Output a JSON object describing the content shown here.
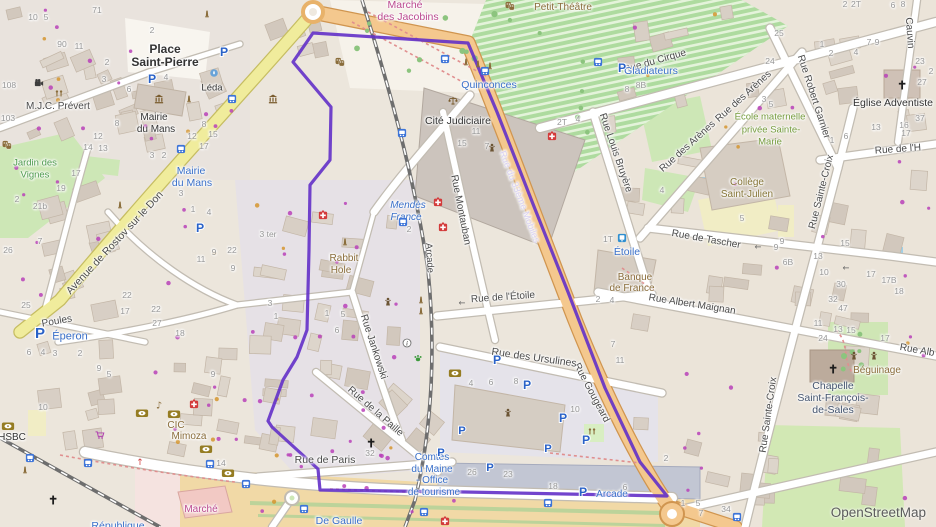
{
  "attribution": {
    "text": "OpenStreetMap"
  },
  "palette": {
    "st": "#4b4b4b",
    "hn": "#979797",
    "tr": "#3a70c9",
    "poi": "#8a6d3b",
    "pl": "#333333",
    "ar": "#4e9a4e",
    "olive": "#769c3e",
    "khaki": "#857537",
    "pink": "#bb4a90",
    "slate": "#44546e",
    "lav": "#d9d1f2",
    "attr": "#5b5b5b",
    "boundary": "#6330c8",
    "parking_blue": "#2a62c8",
    "transit_blue": "#3d74d8",
    "medical_red": "#d33a3a",
    "bank_olive": "#957c22"
  },
  "boundary": {
    "name": "highlighted-district-boundary",
    "points": "313,33 468,43 476,62 497,112 533,204 568,292 605,388 640,462 667,496 465,492 320,490 318,469 272,427 268,421 283,380 297,357 307,330 309,250 310,185 330,160 331,107 293,62"
  },
  "labels": [
    {
      "t": "Place",
      "x": 165,
      "y": 49,
      "k": "pl",
      "s": 12,
      "w": 600
    },
    {
      "t": "Saint-Pierre",
      "x": 165,
      "y": 62,
      "k": "pl",
      "s": 12,
      "w": 600
    },
    {
      "t": "Marché",
      "x": 405,
      "y": 5,
      "k": "poi",
      "c": "pink",
      "s": 10.5
    },
    {
      "t": "des Jacobins",
      "x": 408,
      "y": 17,
      "k": "poi",
      "c": "pink",
      "s": 10.5
    },
    {
      "t": "Petit-Théâtre",
      "x": 563,
      "y": 8,
      "k": "poi"
    },
    {
      "t": "Rue du Cirque",
      "x": 655,
      "y": 62,
      "r": -16
    },
    {
      "t": "Cauvin",
      "x": 909,
      "y": 33,
      "r": 86
    },
    {
      "t": "Rue Robert Garnier",
      "x": 813,
      "y": 97,
      "r": 72
    },
    {
      "t": "Rue de l'H",
      "x": 898,
      "y": 150,
      "r": -4
    },
    {
      "t": "Église Adventiste",
      "x": 893,
      "y": 103,
      "k": "pl",
      "s": 10.5
    },
    {
      "t": "Gladiateurs",
      "x": 651,
      "y": 71,
      "k": "tr",
      "s": 10.5
    },
    {
      "t": "Quinconces",
      "x": 489,
      "y": 85,
      "k": "tr",
      "s": 10.5
    },
    {
      "t": "Rue Louis Bruyère",
      "x": 615,
      "y": 153,
      "r": 71
    },
    {
      "t": "Rue des Arènes",
      "x": 688,
      "y": 147,
      "r": -42
    },
    {
      "t": "Rue des Arènes",
      "x": 744,
      "y": 97,
      "r": -42
    },
    {
      "t": "École maternelle",
      "x": 770,
      "y": 117,
      "k": "ar",
      "c": "olive",
      "s": 9.5
    },
    {
      "t": "privée Sainte-",
      "x": 771,
      "y": 130,
      "k": "ar",
      "c": "olive",
      "s": 9.5
    },
    {
      "t": "Marie",
      "x": 770,
      "y": 142,
      "k": "ar",
      "c": "olive",
      "s": 9.5
    },
    {
      "t": "Collège",
      "x": 747,
      "y": 183,
      "k": "ar",
      "c": "khaki"
    },
    {
      "t": "Saint-Julien",
      "x": 747,
      "y": 195,
      "k": "ar",
      "c": "khaki"
    },
    {
      "t": "Rue de Tascher",
      "x": 706,
      "y": 240,
      "r": 10
    },
    {
      "t": "Étoile",
      "x": 627,
      "y": 252,
      "k": "tr",
      "s": 10.5
    },
    {
      "t": "Banque",
      "x": 635,
      "y": 278,
      "k": "poi"
    },
    {
      "t": "de France",
      "x": 632,
      "y": 289,
      "k": "poi"
    },
    {
      "t": "Rue Albert Maignan",
      "x": 692,
      "y": 305,
      "r": 9
    },
    {
      "t": "Rue Alb",
      "x": 917,
      "y": 351,
      "r": 10
    },
    {
      "t": "Rue Sainte-Croix",
      "x": 822,
      "y": 192,
      "r": -76
    },
    {
      "t": "Rue Sainte-Croix",
      "x": 769,
      "y": 415,
      "r": -82
    },
    {
      "t": "Béguinage",
      "x": 877,
      "y": 371,
      "k": "poi"
    },
    {
      "t": "Chapelle",
      "x": 833,
      "y": 386,
      "k": "pl",
      "c": "slate",
      "s": 10.5
    },
    {
      "t": "Saint-François-",
      "x": 833,
      "y": 398,
      "k": "pl",
      "c": "slate",
      "s": 10.5
    },
    {
      "t": "de-Sales",
      "x": 833,
      "y": 410,
      "k": "pl",
      "c": "slate",
      "s": 10.5
    },
    {
      "t": "Cité Judiciaire",
      "x": 458,
      "y": 121,
      "k": "pl",
      "s": 10.5
    },
    {
      "t": "Rue Montauban",
      "x": 460,
      "y": 210,
      "r": 79
    },
    {
      "t": "Mendès",
      "x": 408,
      "y": 206,
      "k": "tr",
      "i": 1
    },
    {
      "t": "France",
      "x": 406,
      "y": 218,
      "k": "tr",
      "i": 1
    },
    {
      "t": "Arcade",
      "x": 429,
      "y": 258,
      "r": 86,
      "s": 9.5
    },
    {
      "t": "Rabbit",
      "x": 344,
      "y": 259,
      "k": "poi"
    },
    {
      "t": "Hole",
      "x": 341,
      "y": 271,
      "k": "poi"
    },
    {
      "t": "Rue du 33ème Mobiles",
      "x": 519,
      "y": 197,
      "r": 69,
      "c": "lav",
      "s": 9.5
    },
    {
      "t": "Rue Gougeard",
      "x": 591,
      "y": 393,
      "r": 62
    },
    {
      "t": "Rue de l'Étoile",
      "x": 503,
      "y": 298,
      "r": -4
    },
    {
      "t": "Rue des Ursulines",
      "x": 534,
      "y": 358,
      "r": 8,
      "s": 10.5
    },
    {
      "t": "Rue Jankowski",
      "x": 373,
      "y": 347,
      "r": 72
    },
    {
      "t": "Rue de la Paille",
      "x": 375,
      "y": 412,
      "r": 41
    },
    {
      "t": "Rue de Paris",
      "x": 325,
      "y": 460,
      "s": 10.5
    },
    {
      "t": "Avenue de Rostov sur le Don",
      "x": 115,
      "y": 243,
      "r": -47,
      "s": 10.5
    },
    {
      "t": "Poules",
      "x": 57,
      "y": 322,
      "r": -10
    },
    {
      "t": "Jardin des",
      "x": 35,
      "y": 163,
      "k": "ar",
      "s": 9.5
    },
    {
      "t": "Vignes",
      "x": 35,
      "y": 175,
      "k": "ar",
      "s": 9.5
    },
    {
      "t": "M.J.C. Prévert",
      "x": 58,
      "y": 107
    },
    {
      "t": "Mairie",
      "x": 154,
      "y": 118,
      "k": "pl"
    },
    {
      "t": "du Mans",
      "x": 156,
      "y": 130,
      "k": "pl"
    },
    {
      "t": "Léda",
      "x": 212,
      "y": 88,
      "k": "pl",
      "s": 9.5
    },
    {
      "t": "Mairie",
      "x": 191,
      "y": 171,
      "k": "tr",
      "s": 10.5
    },
    {
      "t": "du Mans",
      "x": 192,
      "y": 183,
      "k": "tr",
      "s": 10.5
    },
    {
      "t": "Éperon",
      "x": 70,
      "y": 337,
      "k": "tr",
      "s": 11
    },
    {
      "t": "CIC",
      "x": 176,
      "y": 426,
      "k": "poi"
    },
    {
      "t": "Mimoza",
      "x": 189,
      "y": 437,
      "k": "poi"
    },
    {
      "t": "HSBC",
      "x": 12,
      "y": 438,
      "k": "pl"
    },
    {
      "t": "Marché",
      "x": 201,
      "y": 510,
      "k": "poi",
      "c": "pink"
    },
    {
      "t": "Comtes",
      "x": 432,
      "y": 458,
      "k": "tr"
    },
    {
      "t": "du Maine",
      "x": 432,
      "y": 470,
      "k": "tr"
    },
    {
      "t": "- Office",
      "x": 432,
      "y": 481,
      "k": "tr"
    },
    {
      "t": "de tourisme",
      "x": 434,
      "y": 493,
      "k": "tr"
    },
    {
      "t": "De Gaulle",
      "x": 339,
      "y": 521,
      "k": "tr",
      "s": 10.5
    },
    {
      "t": "République",
      "x": 118,
      "y": 526,
      "k": "tr",
      "s": 10.5
    },
    {
      "t": "Arcade",
      "x": 612,
      "y": 495,
      "k": "tr"
    }
  ],
  "house_numbers": [
    [
      "71",
      97,
      10
    ],
    [
      "90",
      62,
      44
    ],
    [
      "11",
      79,
      46
    ],
    [
      "108",
      9,
      85
    ],
    [
      "103",
      8,
      118
    ],
    [
      "2",
      107,
      62
    ],
    [
      "10",
      33,
      17
    ],
    [
      "5",
      46,
      17
    ],
    [
      "2",
      152,
      30
    ],
    [
      "4",
      166,
      77
    ],
    [
      "3",
      104,
      79
    ],
    [
      "6",
      129,
      89
    ],
    [
      "8",
      117,
      123
    ],
    [
      "12",
      98,
      136
    ],
    [
      "13",
      103,
      148
    ],
    [
      "14",
      88,
      147
    ],
    [
      "3",
      152,
      155
    ],
    [
      "2",
      164,
      155
    ],
    [
      "8",
      204,
      124
    ],
    [
      "12",
      192,
      136
    ],
    [
      "15",
      213,
      134
    ],
    [
      "17",
      204,
      146
    ],
    [
      "17",
      76,
      173
    ],
    [
      "19",
      61,
      188
    ],
    [
      "21b",
      40,
      206
    ],
    [
      "2",
      17,
      199
    ],
    [
      "7",
      40,
      241
    ],
    [
      "26",
      8,
      250
    ],
    [
      "3",
      181,
      193
    ],
    [
      "1",
      193,
      209
    ],
    [
      "4",
      209,
      212
    ],
    [
      "9",
      214,
      252
    ],
    [
      "11",
      201,
      259
    ],
    [
      "22",
      232,
      250
    ],
    [
      "9",
      233,
      268
    ],
    [
      "3 ter",
      268,
      234
    ],
    [
      "22",
      127,
      295
    ],
    [
      "25",
      26,
      305
    ],
    [
      "17",
      125,
      311
    ],
    [
      "22",
      156,
      309
    ],
    [
      "27",
      157,
      323
    ],
    [
      "18",
      180,
      333
    ],
    [
      "6",
      29,
      352
    ],
    [
      "4",
      43,
      352
    ],
    [
      "3",
      55,
      353
    ],
    [
      "2",
      80,
      353
    ],
    [
      "9",
      99,
      368
    ],
    [
      "5",
      109,
      374
    ],
    [
      "10",
      43,
      407
    ],
    [
      "9",
      213,
      374
    ],
    [
      "14",
      221,
      463
    ],
    [
      "3",
      270,
      303
    ],
    [
      "1",
      276,
      316
    ],
    [
      "1",
      327,
      313
    ],
    [
      "5",
      343,
      314
    ],
    [
      "6",
      337,
      330
    ],
    [
      "32",
      370,
      453
    ],
    [
      "26",
      472,
      472
    ],
    [
      "23",
      508,
      474
    ],
    [
      "18",
      553,
      486
    ],
    [
      "6",
      625,
      487
    ],
    [
      "1",
      683,
      503
    ],
    [
      "10",
      575,
      409
    ],
    [
      "4",
      471,
      383
    ],
    [
      "6",
      491,
      382
    ],
    [
      "8",
      516,
      381
    ],
    [
      "7",
      613,
      344
    ],
    [
      "11",
      620,
      360
    ],
    [
      "2",
      666,
      458
    ],
    [
      "8",
      627,
      89
    ],
    [
      "8B",
      641,
      85
    ],
    [
      "2T",
      562,
      122
    ],
    [
      "4",
      578,
      119
    ],
    [
      "11",
      476,
      131
    ],
    [
      "15",
      462,
      143
    ],
    [
      "7",
      487,
      146
    ],
    [
      "2",
      845,
      4
    ],
    [
      "2T",
      856,
      4
    ],
    [
      "6",
      893,
      5
    ],
    [
      "8",
      903,
      4
    ],
    [
      "25",
      779,
      33
    ],
    [
      "24",
      770,
      61
    ],
    [
      "1",
      822,
      44
    ],
    [
      "2",
      831,
      53
    ],
    [
      "4",
      856,
      52
    ],
    [
      "7",
      869,
      42
    ],
    [
      "9",
      877,
      42
    ],
    [
      "23",
      920,
      61
    ],
    [
      "2",
      931,
      71
    ],
    [
      "27",
      922,
      82
    ],
    [
      "37",
      920,
      118
    ],
    [
      "16",
      904,
      125
    ],
    [
      "17",
      906,
      133
    ],
    [
      "13",
      876,
      127
    ],
    [
      "6",
      846,
      136
    ],
    [
      "1",
      832,
      140
    ],
    [
      "3",
      764,
      99
    ],
    [
      "5",
      771,
      104
    ],
    [
      "15",
      845,
      243
    ],
    [
      "13",
      818,
      256
    ],
    [
      "10",
      824,
      272
    ],
    [
      "17",
      871,
      274
    ],
    [
      "17B",
      889,
      280
    ],
    [
      "18",
      899,
      291
    ],
    [
      "30",
      841,
      284
    ],
    [
      "32",
      833,
      299
    ],
    [
      "47",
      843,
      308
    ],
    [
      "11",
      818,
      323
    ],
    [
      "13",
      838,
      329
    ],
    [
      "15",
      851,
      330
    ],
    [
      "24",
      823,
      338
    ],
    [
      "17",
      885,
      338
    ],
    [
      "9",
      782,
      241
    ],
    [
      "6B",
      788,
      262
    ],
    [
      "5",
      742,
      218
    ],
    [
      "9",
      776,
      247
    ],
    [
      "2",
      598,
      299
    ],
    [
      "4",
      612,
      300
    ],
    [
      "34",
      726,
      509
    ],
    [
      "5",
      698,
      503
    ],
    [
      "7",
      701,
      513
    ],
    [
      "1T",
      608,
      239
    ],
    [
      "4",
      662,
      190
    ],
    [
      "2",
      409,
      229
    ]
  ],
  "icons": [
    [
      "parking",
      40,
      333,
      16
    ],
    [
      "parking",
      622,
      68,
      13
    ],
    [
      "parking",
      200,
      228,
      13
    ],
    [
      "parking",
      152,
      79,
      13
    ],
    [
      "parking",
      224,
      52,
      13
    ],
    [
      "parking",
      497,
      360,
      13
    ],
    [
      "parking",
      527,
      385,
      13
    ],
    [
      "parking",
      563,
      418,
      13
    ],
    [
      "parking",
      586,
      440,
      13
    ],
    [
      "parking",
      548,
      448,
      12
    ],
    [
      "parking",
      462,
      430,
      12
    ],
    [
      "parking",
      441,
      452,
      12
    ],
    [
      "parking",
      490,
      467,
      12
    ],
    [
      "parking",
      583,
      492,
      13
    ],
    [
      "bus",
      598,
      62
    ],
    [
      "bus",
      445,
      59
    ],
    [
      "bus",
      485,
      71
    ],
    [
      "bus",
      232,
      99
    ],
    [
      "bus",
      181,
      149
    ],
    [
      "bus",
      402,
      133
    ],
    [
      "bus",
      403,
      222
    ],
    [
      "bus",
      246,
      484
    ],
    [
      "bus",
      304,
      509
    ],
    [
      "bus",
      424,
      512
    ],
    [
      "bus",
      548,
      503
    ],
    [
      "bus",
      30,
      458
    ],
    [
      "bus",
      88,
      463
    ],
    [
      "bus",
      210,
      464
    ],
    [
      "bus",
      737,
      517
    ],
    [
      "tram",
      622,
      238
    ],
    [
      "medical",
      323,
      215
    ],
    [
      "medical",
      438,
      202
    ],
    [
      "medical",
      443,
      227
    ],
    [
      "medical",
      552,
      136
    ],
    [
      "medical",
      194,
      404
    ],
    [
      "medical",
      445,
      521
    ],
    [
      "bank",
      142,
      413
    ],
    [
      "bank",
      174,
      414
    ],
    [
      "bank",
      455,
      373
    ],
    [
      "bank",
      206,
      449
    ],
    [
      "bank",
      228,
      473
    ],
    [
      "bank",
      8,
      426
    ],
    [
      "masks",
      340,
      62
    ],
    [
      "masks",
      510,
      6
    ],
    [
      "masks",
      7,
      145
    ],
    [
      "museum",
      273,
      99
    ],
    [
      "museum",
      159,
      99
    ],
    [
      "fountain",
      214,
      73
    ],
    [
      "church",
      371,
      443
    ],
    [
      "church",
      53,
      500
    ],
    [
      "church",
      902,
      85
    ],
    [
      "church",
      833,
      369
    ],
    [
      "playground",
      59,
      94
    ],
    [
      "playground",
      592,
      432
    ],
    [
      "cinema",
      39,
      83
    ],
    [
      "music",
      159,
      405
    ],
    [
      "cart",
      100,
      435
    ],
    [
      "paw",
      418,
      358
    ],
    [
      "info",
      407,
      343
    ],
    [
      "statue",
      388,
      302
    ],
    [
      "statue",
      508,
      413
    ],
    [
      "statue",
      854,
      356
    ],
    [
      "statue",
      874,
      356
    ],
    [
      "statue",
      492,
      148
    ],
    [
      "scales",
      453,
      101
    ],
    [
      "monument",
      207,
      14
    ],
    [
      "monument",
      189,
      99
    ],
    [
      "monument",
      345,
      242
    ],
    [
      "monument",
      120,
      205
    ],
    [
      "monument",
      466,
      62
    ],
    [
      "monument",
      478,
      64
    ],
    [
      "monument",
      490,
      66
    ],
    [
      "monument",
      25,
      470
    ],
    [
      "monument",
      421,
      300
    ],
    [
      "monument",
      421,
      311
    ],
    [
      "arrow-left",
      462,
      303
    ],
    [
      "arrow-left",
      758,
      247
    ],
    [
      "arrow-left",
      846,
      268
    ],
    [
      "arrow-up-red",
      140,
      462
    ]
  ]
}
